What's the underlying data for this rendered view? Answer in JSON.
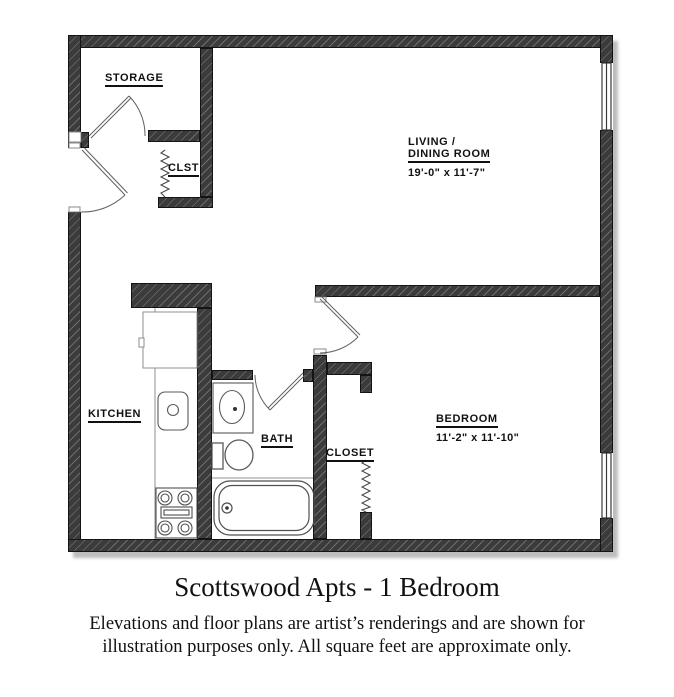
{
  "plan": {
    "rooms": [
      {
        "id": "storage",
        "label": "STORAGE"
      },
      {
        "id": "clst",
        "label": "CLST"
      },
      {
        "id": "living",
        "label_line1": "LIVING /",
        "label_line2": "DINING ROOM",
        "dims": "19'-0\" x 11'-7\""
      },
      {
        "id": "kitchen",
        "label": "KITCHEN"
      },
      {
        "id": "bath",
        "label": "BATH"
      },
      {
        "id": "closet",
        "label": "CLOSET"
      },
      {
        "id": "bedroom",
        "label": "BEDROOM",
        "dims": "11'-2\" x 11'-10\""
      }
    ],
    "fixtures": [
      "refrigerator",
      "kitchen-sink",
      "stove",
      "vanity-sink",
      "toilet",
      "bathtub"
    ],
    "doors": [
      "entry-door",
      "storage-door",
      "bath-door",
      "bedroom-door",
      "clst-accordion-door",
      "closet-accordion-door"
    ],
    "windows": [
      "living-room-window",
      "bedroom-window"
    ]
  },
  "footer": {
    "title": "Scottswood Apts - 1 Bedroom",
    "disclaimer_line1": "Elevations and floor plans are artist’s renderings and are shown for",
    "disclaimer_line2": "illustration purposes only. All square feet are approximate only."
  },
  "colors": {
    "wall": "#3b3b3b",
    "line": "#555555",
    "background": "#ffffff"
  }
}
